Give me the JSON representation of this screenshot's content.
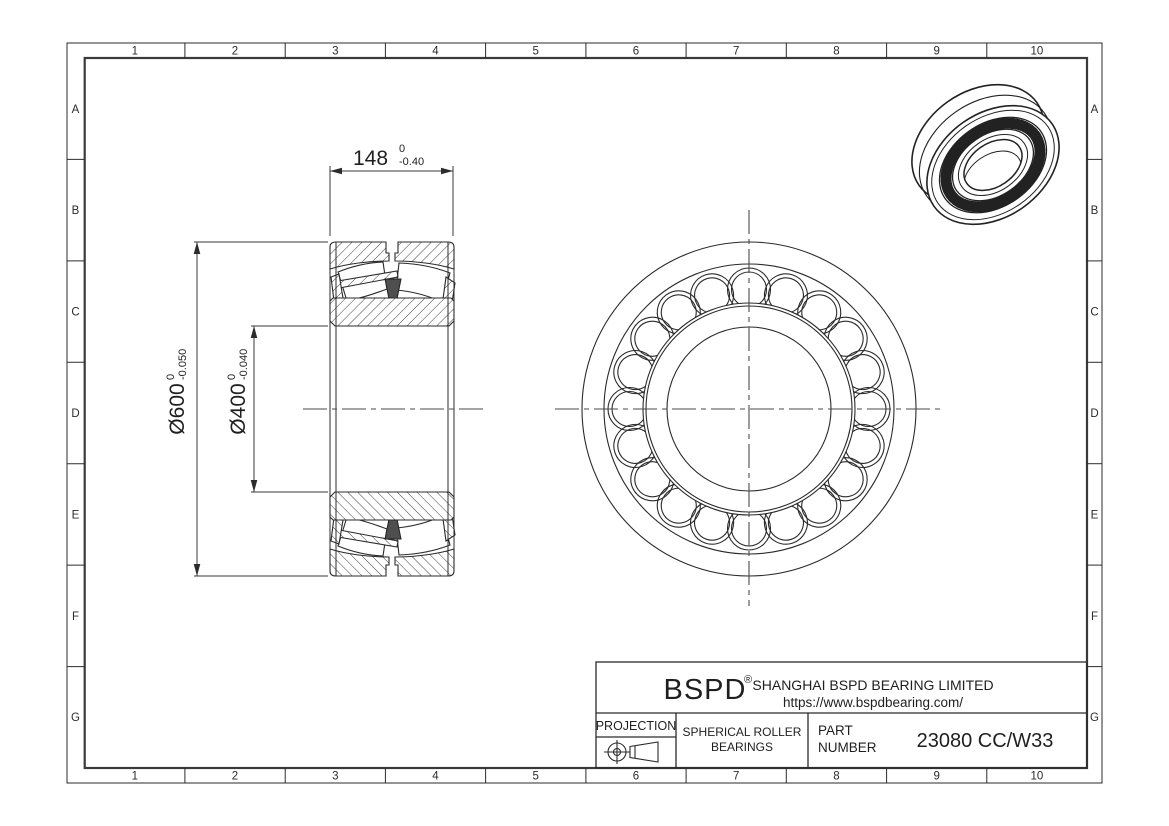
{
  "grid": {
    "cols": [
      "1",
      "2",
      "3",
      "4",
      "5",
      "6",
      "7",
      "8",
      "9",
      "10"
    ],
    "rows": [
      "A",
      "B",
      "C",
      "D",
      "E",
      "F",
      "G"
    ]
  },
  "dimensions": {
    "width": {
      "value": "148",
      "tol_upper": "0",
      "tol_lower": "-0.40"
    },
    "outer_diameter": {
      "value": "Ø600",
      "tol_upper": "0",
      "tol_lower": "-0.050"
    },
    "bore_diameter": {
      "value": "Ø400",
      "tol_upper": "0",
      "tol_lower": "-0.040"
    }
  },
  "title_block": {
    "brand": "BSPD",
    "registered_mark": "®",
    "company": "SHANGHAI BSPD BEARING LIMITED",
    "website": "https://www.bspdbearing.com/",
    "projection_label": "PROJECTION",
    "product_line1": "SPHERICAL ROLLER",
    "product_line2": "BEARINGS",
    "part_label_line1": "PART",
    "part_label_line2": "NUMBER",
    "part_number": "23080 CC/W33"
  },
  "colors": {
    "line": "#2b2b2b",
    "centerline": "#4a4a4a",
    "text": "#1f1f1f"
  }
}
